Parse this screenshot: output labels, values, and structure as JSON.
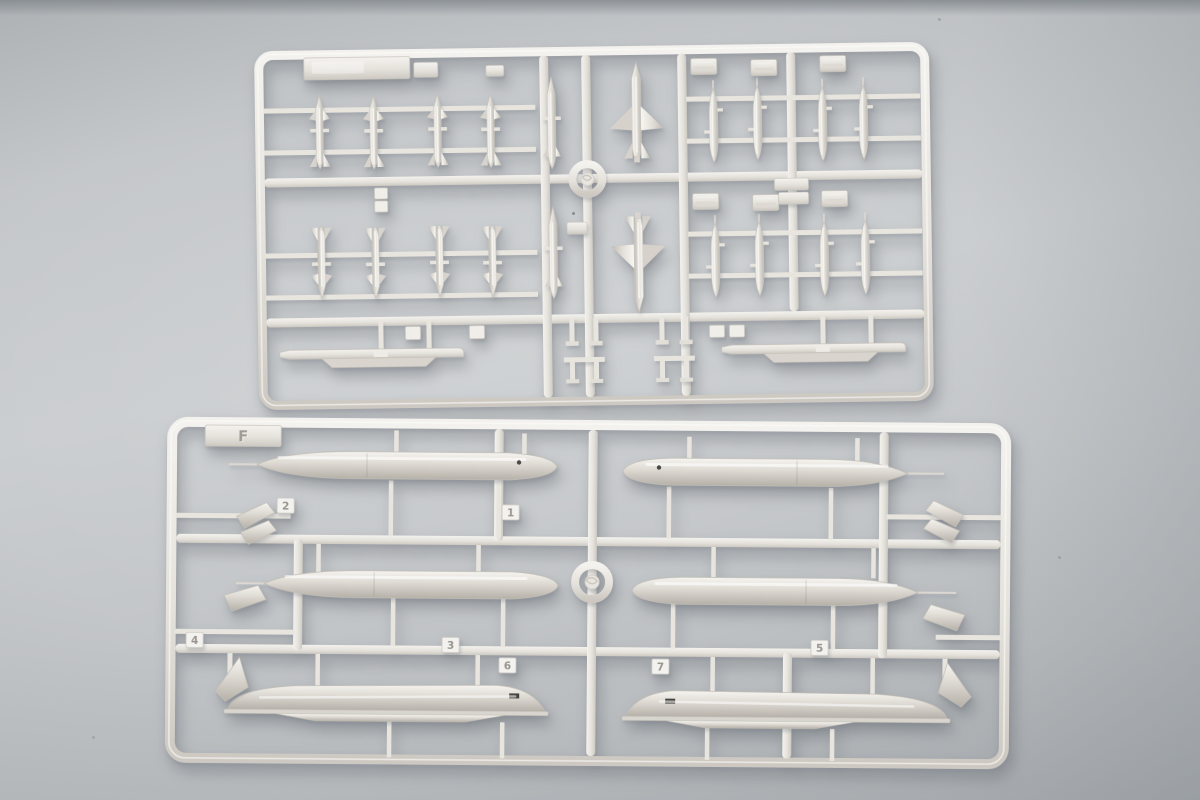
{
  "scene": {
    "type": "photograph",
    "subject": "Two light-gray injection-molded plastic model-kit sprues (runners) holding missile, pylon, launch-rail and drop-tank parts, lying on a gray surface",
    "colors": {
      "surface": "#c6c9cc",
      "surface_top_band": "#8f9499",
      "surface_shadow": "#a9adb1",
      "plastic": "#e9e6e0",
      "plastic_highlight": "#f7f5f1",
      "plastic_shadow": "#c2beb7",
      "slot_dark": "#45443f"
    }
  },
  "sprue_top": {
    "label_tab_text": "",
    "center_ring_mark": "",
    "parts_inventory": {
      "small_finned_missiles": 8,
      "winged_missiles": 4,
      "slender_missiles": 2,
      "small_drop_tanks": 8,
      "pylon_blocks": 8,
      "adapter_blocks": 3,
      "launch_rails": 2,
      "molding_rings": 1
    }
  },
  "sprue_bottom": {
    "label_tab_text": "F",
    "part_number_tags": [
      {
        "label": "1"
      },
      {
        "label": "2"
      },
      {
        "label": "3"
      },
      {
        "label": "4"
      },
      {
        "label": "5"
      },
      {
        "label": "6"
      },
      {
        "label": "7"
      }
    ],
    "parts_inventory": {
      "drop_tanks": 4,
      "drop_tank_half_shells": 2,
      "fin_plates": 6,
      "molding_rings": 1
    }
  }
}
